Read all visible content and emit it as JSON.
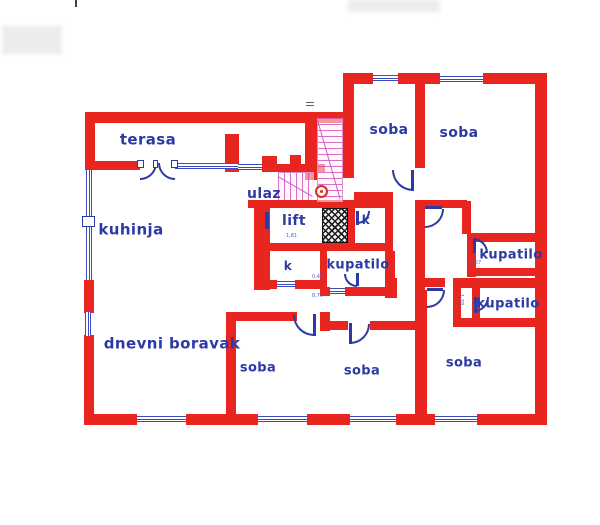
{
  "drawing": {
    "type": "apartment floor plan",
    "accent_wall_color": "#e8251f",
    "label_color": "#2b3aa5",
    "stair_color": "#d65fbe"
  },
  "labels": [
    {
      "id": "terasa",
      "text": "terasa",
      "x": 148,
      "y": 140,
      "s": 15
    },
    {
      "id": "kuhinja",
      "text": "kuhinja",
      "x": 131,
      "y": 230,
      "s": 15
    },
    {
      "id": "ulaz",
      "text": "ulaz",
      "x": 264,
      "y": 194,
      "s": 14
    },
    {
      "id": "lift",
      "text": "lift",
      "x": 294,
      "y": 221,
      "s": 14
    },
    {
      "id": "k-upper",
      "text": "k",
      "x": 366,
      "y": 220,
      "s": 12
    },
    {
      "id": "kupatilo-center",
      "text": "kupatilo",
      "x": 358,
      "y": 265,
      "s": 13
    },
    {
      "id": "k-lower",
      "text": "k",
      "x": 288,
      "y": 266,
      "s": 12
    },
    {
      "id": "kupatilo-right-upper",
      "text": "kupatilo",
      "x": 511,
      "y": 255,
      "s": 13
    },
    {
      "id": "kupatilo-right-lower",
      "text": "kupatilo",
      "x": 508,
      "y": 304,
      "s": 13
    },
    {
      "id": "soba-top-left",
      "text": "soba",
      "x": 389,
      "y": 130,
      "s": 14
    },
    {
      "id": "soba-top-right",
      "text": "soba",
      "x": 459,
      "y": 133,
      "s": 14
    },
    {
      "id": "dnevni-boravak",
      "text": "dnevni boravak",
      "x": 172,
      "y": 344,
      "s": 15
    },
    {
      "id": "soba-bottom-left",
      "text": "soba",
      "x": 258,
      "y": 368,
      "s": 13
    },
    {
      "id": "soba-bottom-middle",
      "text": "soba",
      "x": 362,
      "y": 371,
      "s": 13
    },
    {
      "id": "soba-bottom-right",
      "text": "soba",
      "x": 464,
      "y": 363,
      "s": 13
    }
  ],
  "dimensions": [
    {
      "text": "1,81",
      "x": 286,
      "y": 234,
      "r": 0
    },
    {
      "text": "0,48",
      "x": 312,
      "y": 275,
      "r": 0
    },
    {
      "text": "8,75",
      "x": 312,
      "y": 294,
      "r": 0
    },
    {
      "text": "3,67",
      "x": 470,
      "y": 261,
      "r": 0
    },
    {
      "text": "1,78",
      "x": 463,
      "y": 294,
      "r": 90
    }
  ],
  "plan": {
    "walls": [
      [
        85,
        112,
        263,
        11
      ],
      [
        343,
        73,
        30,
        11
      ],
      [
        398,
        73,
        42,
        11
      ],
      [
        483,
        73,
        64,
        11
      ],
      [
        85,
        112,
        10,
        58
      ],
      [
        85,
        161,
        55,
        9
      ],
      [
        225,
        134,
        14,
        38
      ],
      [
        262,
        156,
        15,
        16
      ],
      [
        262,
        164,
        63,
        8
      ],
      [
        290,
        155,
        11,
        9
      ],
      [
        305,
        112,
        12,
        68
      ],
      [
        343,
        84,
        11,
        94
      ],
      [
        415,
        84,
        10,
        84
      ],
      [
        354,
        192,
        39,
        8
      ],
      [
        415,
        200,
        52,
        8
      ],
      [
        462,
        201,
        9,
        33
      ],
      [
        467,
        233,
        68,
        9
      ],
      [
        467,
        233,
        9,
        44
      ],
      [
        467,
        268,
        68,
        8
      ],
      [
        453,
        278,
        94,
        10
      ],
      [
        423,
        278,
        22,
        9
      ],
      [
        453,
        278,
        8,
        49
      ],
      [
        472,
        288,
        8,
        31
      ],
      [
        453,
        318,
        82,
        9
      ],
      [
        415,
        200,
        10,
        90
      ],
      [
        415,
        290,
        12,
        125
      ],
      [
        226,
        312,
        10,
        103
      ],
      [
        226,
        312,
        71,
        9
      ],
      [
        320,
        312,
        10,
        19
      ],
      [
        328,
        321,
        20,
        9
      ],
      [
        370,
        321,
        45,
        9
      ],
      [
        255,
        280,
        22,
        9
      ],
      [
        295,
        280,
        30,
        9
      ],
      [
        320,
        287,
        10,
        9
      ],
      [
        345,
        287,
        45,
        9
      ],
      [
        385,
        278,
        12,
        20
      ],
      [
        254,
        200,
        16,
        90
      ],
      [
        248,
        200,
        142,
        8
      ],
      [
        348,
        200,
        7,
        51
      ],
      [
        385,
        200,
        8,
        51
      ],
      [
        263,
        243,
        130,
        8
      ],
      [
        320,
        251,
        7,
        38
      ],
      [
        385,
        251,
        10,
        47
      ],
      [
        535,
        73,
        12,
        352
      ],
      [
        85,
        414,
        52,
        11
      ],
      [
        186,
        414,
        72,
        11
      ],
      [
        307,
        414,
        43,
        11
      ],
      [
        396,
        414,
        39,
        11
      ],
      [
        477,
        414,
        70,
        11
      ],
      [
        84,
        280,
        10,
        33
      ],
      [
        84,
        335,
        10,
        90
      ]
    ],
    "windows": [
      {
        "o": "h",
        "x": 175,
        "y": 163,
        "l": 63
      },
      {
        "o": "h",
        "x": 238,
        "y": 164,
        "l": 24
      },
      {
        "o": "h",
        "x": 373,
        "y": 75,
        "l": 25
      },
      {
        "o": "h",
        "x": 440,
        "y": 76,
        "l": 43
      },
      {
        "o": "h",
        "x": 137,
        "y": 416,
        "l": 49
      },
      {
        "o": "h",
        "x": 258,
        "y": 416,
        "l": 49
      },
      {
        "o": "h",
        "x": 350,
        "y": 416,
        "l": 46
      },
      {
        "o": "h",
        "x": 435,
        "y": 416,
        "l": 42
      },
      {
        "o": "h",
        "x": 277,
        "y": 281,
        "l": 18
      },
      {
        "o": "h",
        "x": 330,
        "y": 288,
        "l": 15
      },
      {
        "o": "v",
        "x": 86,
        "y": 170,
        "l": 110
      },
      {
        "o": "v",
        "x": 85,
        "y": 312,
        "l": 24
      }
    ],
    "doors": [
      {
        "x": 140,
        "y": 163,
        "r": 17,
        "o": "br"
      },
      {
        "x": 158,
        "y": 163,
        "r": 17,
        "o": "bl"
      },
      {
        "x": 392,
        "y": 170,
        "r": 21,
        "o": "bl"
      },
      {
        "x": 425,
        "y": 209,
        "r": 19,
        "o": "br"
      },
      {
        "x": 473,
        "y": 238,
        "r": 15,
        "o": "tr"
      },
      {
        "x": 474,
        "y": 297,
        "r": 15,
        "o": "br"
      },
      {
        "x": 427,
        "y": 290,
        "r": 18,
        "o": "br"
      },
      {
        "x": 350,
        "y": 324,
        "r": 20,
        "o": "br"
      },
      {
        "x": 293,
        "y": 315,
        "r": 21,
        "o": "bl"
      },
      {
        "x": 344,
        "y": 274,
        "r": 13,
        "o": "bl"
      },
      {
        "x": 357,
        "y": 211,
        "r": 13,
        "o": "br"
      }
    ],
    "leaves": [
      [
        411,
        170,
        3,
        21
      ],
      [
        425,
        206,
        17,
        3
      ],
      [
        473,
        238,
        3,
        15
      ],
      [
        474,
        297,
        3,
        16
      ],
      [
        427,
        288,
        16,
        3
      ],
      [
        349,
        323,
        3,
        21
      ],
      [
        313,
        314,
        3,
        22
      ],
      [
        356,
        273,
        3,
        13
      ],
      [
        356,
        211,
        3,
        14
      ],
      [
        265,
        212,
        4,
        17
      ]
    ],
    "posts": [
      [
        82,
        216,
        13,
        11
      ],
      [
        137,
        160,
        7,
        8
      ],
      [
        171,
        160,
        7,
        8
      ],
      [
        153,
        160,
        5,
        8
      ]
    ],
    "stairs": {
      "upper": [
        317,
        118,
        26,
        84
      ],
      "lower": [
        278,
        172,
        36,
        28
      ]
    },
    "diagonals": [
      {
        "x": 318,
        "y": 120,
        "len": 82,
        "ang": 74
      },
      {
        "x": 278,
        "y": 176,
        "len": 40,
        "ang": 30
      }
    ],
    "shaft": [
      322,
      208,
      26,
      35
    ],
    "marker_circle": [
      315,
      185,
      13,
      13
    ],
    "marker_dot": [
      320,
      190,
      3,
      3
    ],
    "ticks": [
      [
        306,
        102,
        8,
        1
      ],
      [
        306,
        105,
        8,
        1
      ]
    ],
    "artifacts": [
      {
        "cls": "artifact",
        "x": 2,
        "y": 26,
        "w": 60,
        "h": 28
      },
      {
        "cls": "artifact",
        "x": 348,
        "y": 0,
        "w": 92,
        "h": 12
      },
      {
        "cls": "artifact-dark",
        "x": 75,
        "y": 0,
        "w": 2,
        "h": 7
      }
    ]
  }
}
